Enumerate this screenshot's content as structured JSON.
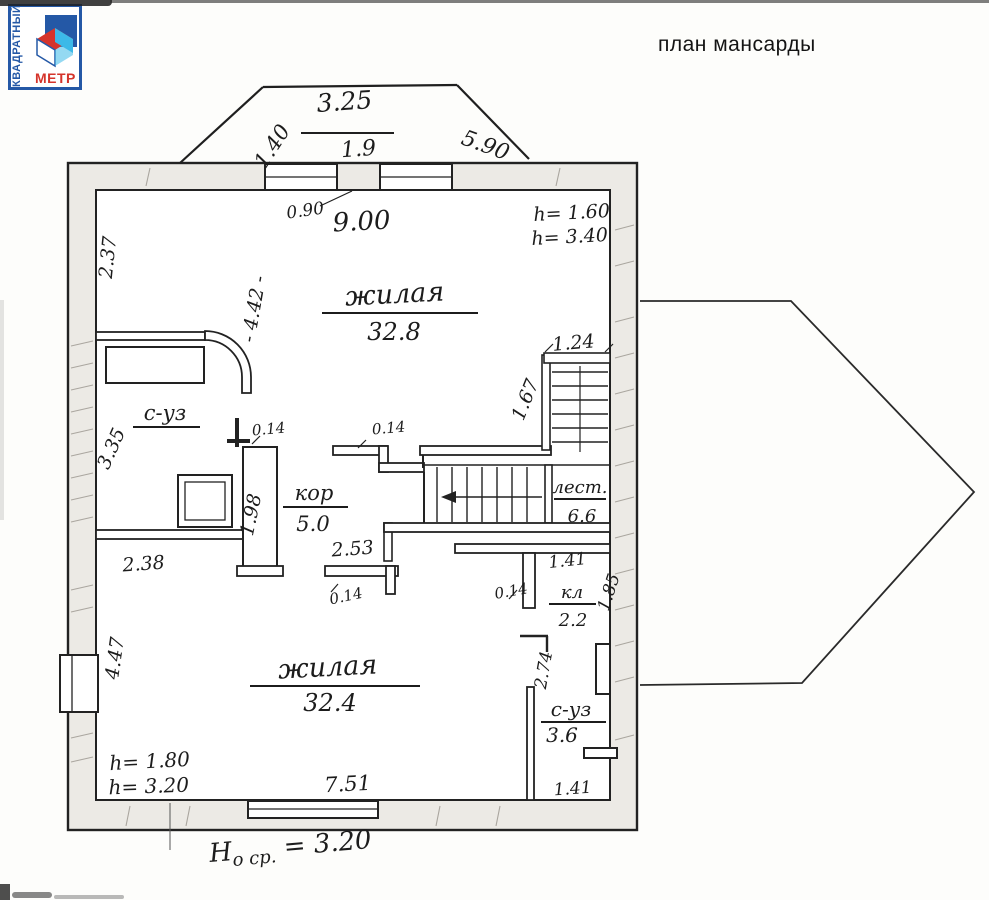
{
  "header": {
    "title": "план мансарды"
  },
  "logo": {
    "side_text": "КВАДРАТНЫЙ",
    "bottom_text": "МЕТР",
    "border_color": "#2458a6",
    "red": "#d5342b",
    "cyan": "#3cb9e8"
  },
  "rooms": {
    "living_top": {
      "name": "жилая",
      "area": "32.8"
    },
    "bath_top": {
      "name": "с-уз"
    },
    "corridor": {
      "name": "кор",
      "area": "5.0"
    },
    "stairs": {
      "name": "лест.",
      "area": "6.6"
    },
    "closet": {
      "name": "кл",
      "area": "2.2"
    },
    "living_bottom": {
      "name": "жилая",
      "area": "32.4"
    },
    "bath_bottom": {
      "name": "с-уз",
      "area": "3.6"
    }
  },
  "dimensions": {
    "dormer_top": "3.25",
    "dormer_left": "1.40",
    "dormer_inner": "1.9",
    "dormer_right": "5.90",
    "top_door": "0.90",
    "top_width": "9.00",
    "h_top_1": "h= 1.60",
    "h_top_2": "h= 3.40",
    "left_top": "2.37",
    "living_top_height": "- 4.42 -",
    "stair_top": "1.24",
    "stair_shaft": "1.67",
    "part_top_left": "0.14",
    "part_top_right": "0.14",
    "bath_top_height": "3.35",
    "corridor_west": "1.98",
    "bath_top_width": "2.38",
    "corridor_width": "2.53",
    "corridor_tick": "0.14",
    "closet_top": "1.41",
    "closet_left": "0.14",
    "closet_side": "1.85",
    "living_bottom_height": "4.47",
    "bath_bottom_height": "2.74",
    "h_bottom_1": "h= 1.80",
    "h_bottom_2": "h= 3.20",
    "living_bottom_width": "7.51",
    "bath_bottom_width": "1.41"
  },
  "footer": {
    "h": "H",
    "sub": "о ср.",
    "value": " = 3.20"
  }
}
